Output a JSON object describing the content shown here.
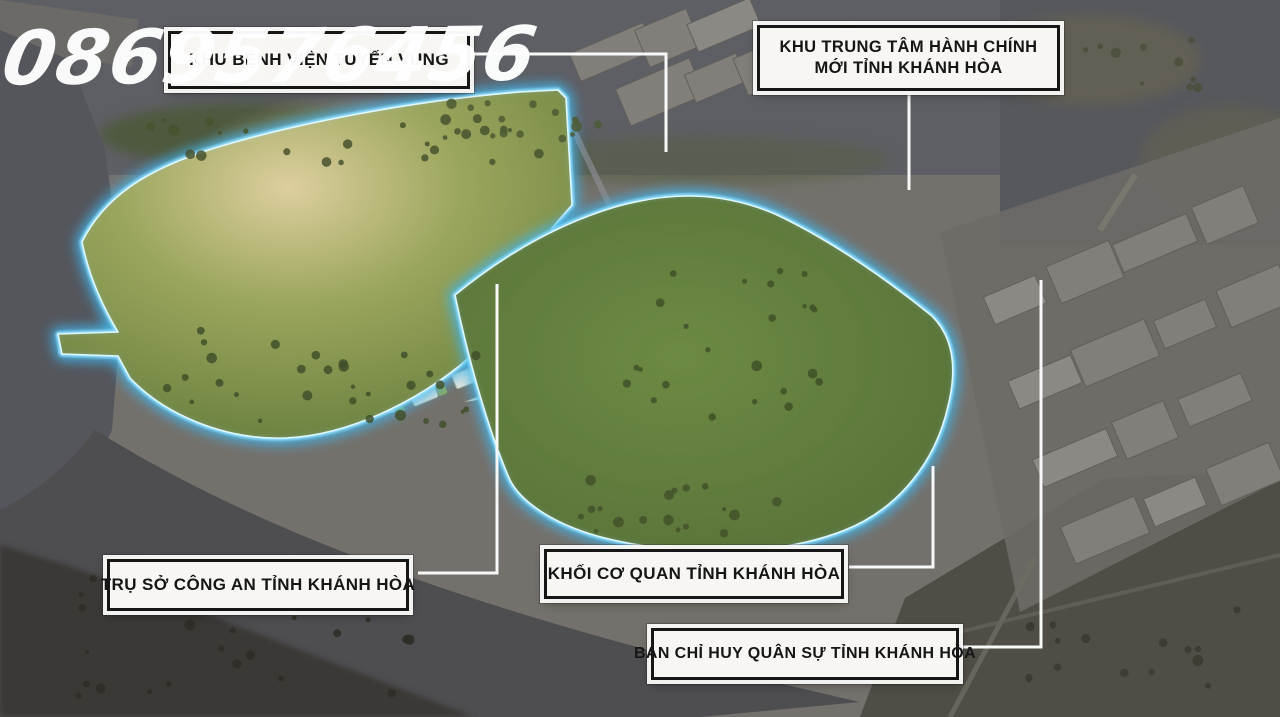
{
  "watermark": "0869576456",
  "callouts": [
    {
      "id": "hospital",
      "label": "KHU BỆNH VIỆN TUYẾN VÙNG"
    },
    {
      "id": "admin-center",
      "label": "KHU TRUNG TÂM HÀNH CHÍNH MỚI TỈNH KHÁNH HÒA"
    },
    {
      "id": "police-hq",
      "label": "TRỤ SỞ CÔNG AN TỈNH KHÁNH HÒA"
    },
    {
      "id": "province-agencies",
      "label": "KHỐI CƠ QUAN TỈNH KHÁNH HÒA"
    },
    {
      "id": "military-command",
      "label": "BAN CHỈ HUY QUÂN SỰ TỈNH KHÁNH HÒA"
    }
  ],
  "colors": {
    "boundary_glow": "#5fcdf7",
    "callout_bg": "#f7f6f3",
    "callout_border": "#161616",
    "callout_text": "#161616",
    "watermark_text": "#ffffff"
  }
}
